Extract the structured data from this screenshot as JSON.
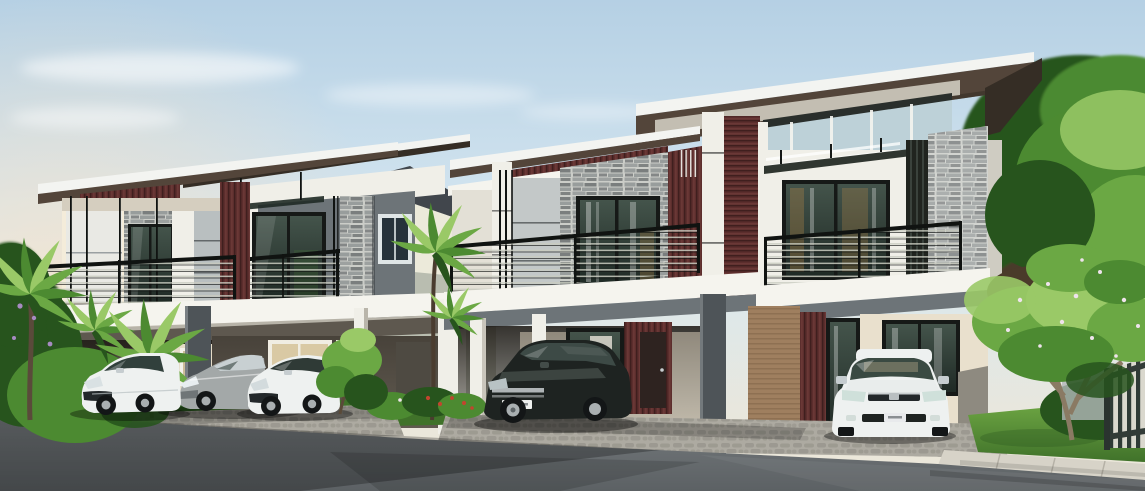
{
  "meta": {
    "description": "3D architectural rendering of modern two-storey semi-detached houses with maroon timber slat accents, stacked stone feature walls, black balcony railings and five cars parked in the carports, surrounded by tropical trees, a lawn, a paved driveway and an asphalt road in the foreground.",
    "width_px": 1145,
    "height_px": 491,
    "time_of_day": "early morning, warm glow at left horizon"
  },
  "palette": {
    "sky_top": "#b5d0e4",
    "sky_mid": "#d8e8f1",
    "sky_low": "#ebe7da",
    "sky_warm": "#f8e3c8",
    "cloud": "#ffffff",
    "wall_white": "#f0efe8",
    "wall_lit": "#f4ecda",
    "wall_cream": "#e9e0cd",
    "wall_panel": "#c6cbca",
    "wall_gray": "#6d7478",
    "wall_gray_dark": "#4e5458",
    "wall_gray_light": "#b2b7b8",
    "maroon": "#5c2e2d",
    "maroon_dark": "#3f1f1e",
    "maroon_light": "#7d4642",
    "stone_light": "#cbcdc8",
    "stone_mid": "#989d9c",
    "stone_dark": "#656a6b",
    "roof_white": "#f3f4f1",
    "roof_brown": "#53453a",
    "roof_dark": "#352d25",
    "frame_black": "#161917",
    "glass_dark": "#1f2a25",
    "glass_mid": "#44544b",
    "glass_light": "#bdd1d8",
    "glass_warm": "#b08448",
    "rail_black": "#101311",
    "rail_bar": "#c9cbc0",
    "slab_white": "#f5f4ee",
    "slab_shadow": "#b7b3a8",
    "concrete": "#d7d3c8",
    "cobble": "#adaaa1",
    "cobble_dark": "#8e8b82",
    "road": "#5c6164",
    "road_dark": "#44484b",
    "road_light": "#767b7e",
    "grass": "#71aa45",
    "grass_dark": "#40722a",
    "leaf_light": "#9ac967",
    "leaf_mid": "#6ba844",
    "leaf": "#4c8a31",
    "leaf_dark": "#27541d",
    "trunk": "#6e5b47",
    "trunk_dark": "#4a3c2f",
    "flower_red": "#c1452e",
    "flower_purple": "#a78bc2",
    "flower_white": "#efe3ec",
    "car_white": "#eef1f0",
    "car_white_shade": "#c6cdd0",
    "car_gray": "#a3a8a8",
    "car_gray_dark": "#6f7577",
    "car_black": "#1e2321",
    "car_black_hi": "#434c49",
    "tire": "#131617",
    "alloy": "#a9afb1",
    "tan_wall": "#9f7f5f",
    "fence": "#2f3a36"
  },
  "scene": {
    "houses": [
      {
        "id": "house-1",
        "position": "left, farther from camera",
        "storeys": 2,
        "units": 2,
        "features": [
          "slanted modern flat roofs with white fascia",
          "maroon vertical timber-slat accent panels",
          "stacked stone pillars",
          "dark framed sliding glass doors",
          "black metal balcony railings",
          "open double carport on ground floor"
        ]
      },
      {
        "id": "house-2",
        "position": "right, closer to camera",
        "storeys": 2,
        "units": 2,
        "features": [
          "large slanted roof rising to the right",
          "stacked stone feature wall with sliding door",
          "maroon slat frieze and columns",
          "pale blue clerestory glass band",
          "glass canopy over balcony door",
          "open carports with entry doors behind cars"
        ]
      },
      {
        "id": "house-3",
        "position": "background centre between the two duplexes",
        "storeys": 2,
        "units": 1,
        "features": [
          "white gable wall",
          "small blue-grey framed windows"
        ]
      }
    ],
    "cars": [
      {
        "id": "car-1",
        "type": "compact hatchback",
        "color": "white",
        "facing": "left",
        "location": "house-1 left carport"
      },
      {
        "id": "car-2",
        "type": "sedan",
        "color": "silver grey",
        "facing": "left",
        "location": "house-1 carport, middle"
      },
      {
        "id": "car-3",
        "type": "hatchback",
        "color": "white",
        "facing": "left",
        "location": "house-1 right carport"
      },
      {
        "id": "car-4",
        "type": "SUV",
        "color": "black",
        "facing": "left",
        "location": "house-2 left carport",
        "license_plate": "white plate, text unreadable"
      },
      {
        "id": "car-5",
        "type": "sedan",
        "color": "white",
        "facing": "camera",
        "location": "house-2 right carport",
        "license_plate": "unreadable"
      }
    ],
    "vegetation": {
      "left": "dense palm cluster with purple blossoms and white rail fence",
      "middle": "tall slender palm between the houses, shrubs with red flowers",
      "right": "frangipani tree with pale blossoms on a lawn, large leafy trees behind the house",
      "foreground_bush": "leafy shrub overlapping the white hatchback"
    },
    "ground": {
      "driveway": "grey cobblestone aprons in front of both carports",
      "sidewalk": "light concrete slabs on the right in front of the lawn",
      "road": "dark asphalt across the whole foreground with long tree shadows",
      "fence_right": "dark vertical-bar metal fence at far right"
    }
  }
}
